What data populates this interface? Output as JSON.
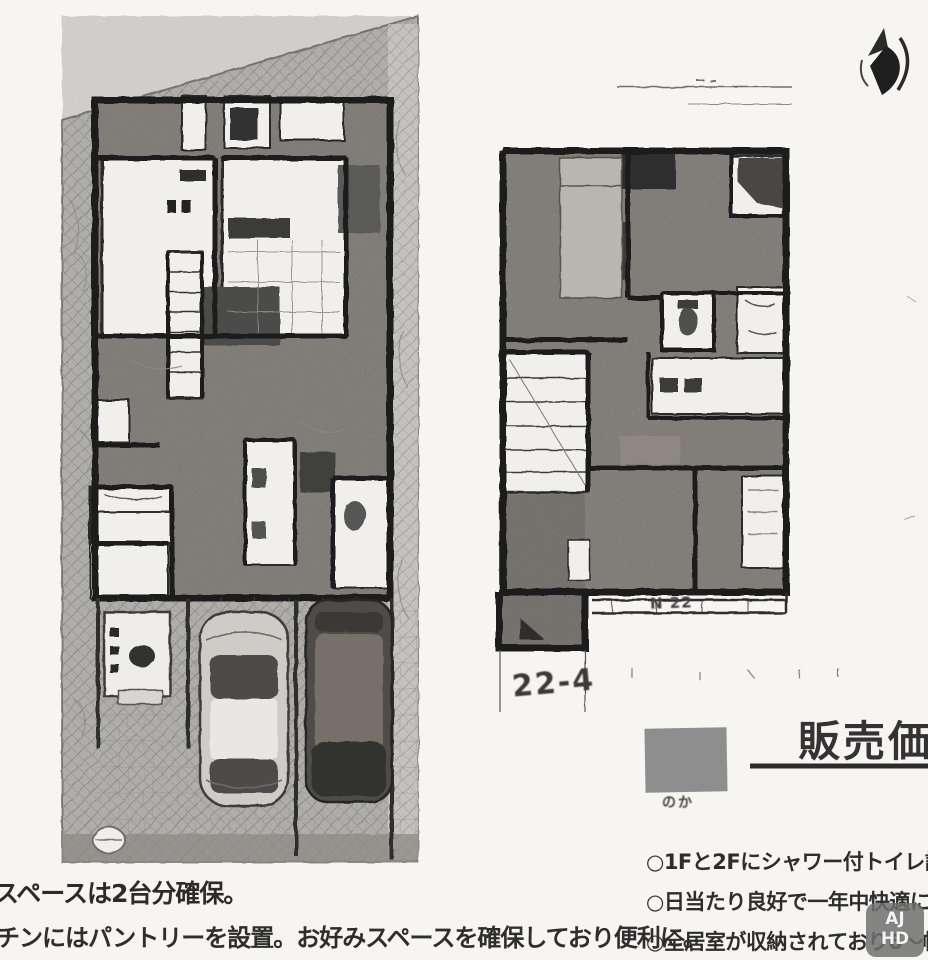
{
  "document": {
    "type": "real-estate floor plan flyer (black & white scan)",
    "floors": [
      {
        "id": "1F",
        "description": "ground floor plan with site, two parking spaces and two cars"
      },
      {
        "id": "2F",
        "description": "second floor plan with balcony"
      }
    ]
  },
  "annotations": {
    "dimension_label": "22-4",
    "balcony_scribble": "N 22"
  },
  "price_section": {
    "heading": "販売価格",
    "swatch_caption": "のか"
  },
  "features": {
    "items": [
      "○1Fと2Fにシャワー付トイレ設",
      "○日当たり良好で一年中快適に",
      "○全居室が収納されており6〜帖"
    ]
  },
  "notes": {
    "line1": "スペースは2台分確保。",
    "line2": "チンにはパントリーを設置。お好みスペースを確保しており便利に。"
  },
  "watermark": {
    "line1": "AJ",
    "line2": "HD"
  },
  "icons": {
    "north_arrow": "compass-north-arrow",
    "car_light": "sedan-top-view",
    "car_dark": "van-top-view"
  },
  "colors": {
    "paper": "#f7f5f2",
    "wall": "#1c1c1c",
    "site_texture": "#d2d0cc",
    "floor_texture": "#a5a19b",
    "furniture_dark": "#4a4745",
    "swatch_gray": "#8e8e8e"
  }
}
